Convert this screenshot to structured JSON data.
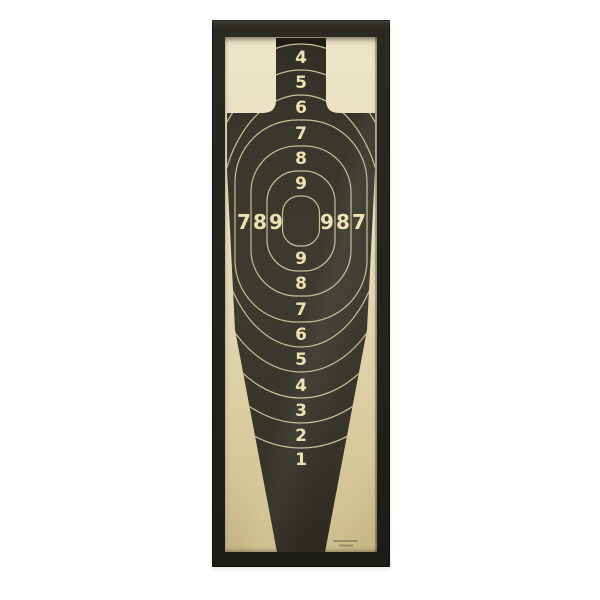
{
  "photo": {
    "background_color": "#ffffff",
    "frame_color": "#24231d",
    "paper_color_top": "#ece5c8",
    "paper_color_bottom": "#cfbf8d",
    "silhouette_color": "#3a372d",
    "silhouette_cap_color": "#1d1c17",
    "ring_line_color": "#c9be94",
    "number_color": "#ebe1b2"
  },
  "target": {
    "top_numbers": [
      "4",
      "5",
      "6",
      "7",
      "8",
      "9"
    ],
    "middle_left_numbers": [
      "7",
      "8",
      "9"
    ],
    "middle_right_numbers": [
      "9",
      "8",
      "7"
    ],
    "bottom_numbers": [
      "9",
      "8",
      "7",
      "6",
      "5",
      "4",
      "3",
      "2",
      "1"
    ]
  }
}
